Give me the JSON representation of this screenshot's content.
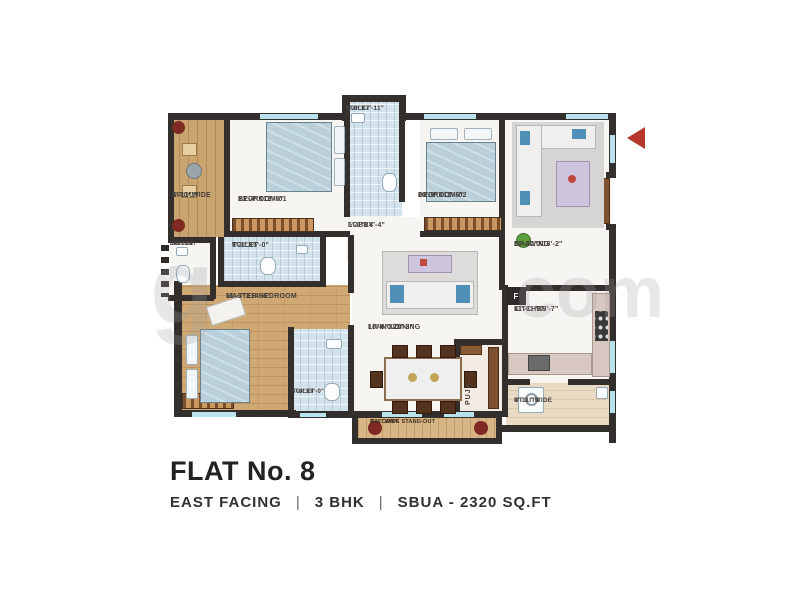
{
  "plan": {
    "rooms": {
      "sitout": {
        "line1": "4'-11\"WIDE",
        "line2": "SITOUT"
      },
      "service_balcony": {
        "line1": "SERVICE",
        "line2": "BALCONY"
      },
      "bedroom1": {
        "line1": "BEDROOM-01",
        "line2": "13'-4\"X12'-5\""
      },
      "toilet_top": {
        "line1": "TOILET",
        "line2": "5'-0\"X7'-11\""
      },
      "lobby": {
        "line1": "LOBBY",
        "line2": "5'-0\"X4'-4\""
      },
      "bedroom2": {
        "line1": "BEDROOM-02",
        "line2": "10'-9\"X12'-5\""
      },
      "drawing": {
        "line1": "DRAWING",
        "line2": "11'-11\"X18'-2\""
      },
      "toilet_mid": {
        "line1": "TOILET",
        "line2": "8'-1\"X5'-0\""
      },
      "master_bedroom": {
        "line1": "MASTER BEDROOM",
        "line2": "11'-7\"X14'-6\""
      },
      "toilet_master": {
        "line1": "TOILET",
        "line2": "6'-0\"X9'-0\""
      },
      "living_dining": {
        "line1": "LIVING/DINING",
        "line2": "16'-6\"X20'-3\""
      },
      "puja": {
        "line1": "PUJA"
      },
      "kitchen": {
        "line1": "KITCHEN",
        "line2": "11'-11\"X9'-7\"",
        "fridge_label": "F"
      },
      "utility": {
        "line1": "UTILITY",
        "line2": "4'-11\" WIDE"
      },
      "balcony": {
        "line1": "2'-4\" WIDE STAND-OUT",
        "line2": "BALCONY"
      }
    }
  },
  "footer": {
    "title": "FLAT No. 8",
    "facing": "EAST FACING",
    "bhk": "3 BHK",
    "area": "SBUA - 2320 SQ.FT",
    "separator": "|"
  },
  "watermark": {
    "left": "g",
    "right": "com"
  },
  "colors": {
    "wall": "#332f2d",
    "wood_floor": "#c9a46e",
    "tile_floor": "#d3e2eb",
    "entrance_arrow": "#b5372c",
    "title_text": "#242220"
  }
}
